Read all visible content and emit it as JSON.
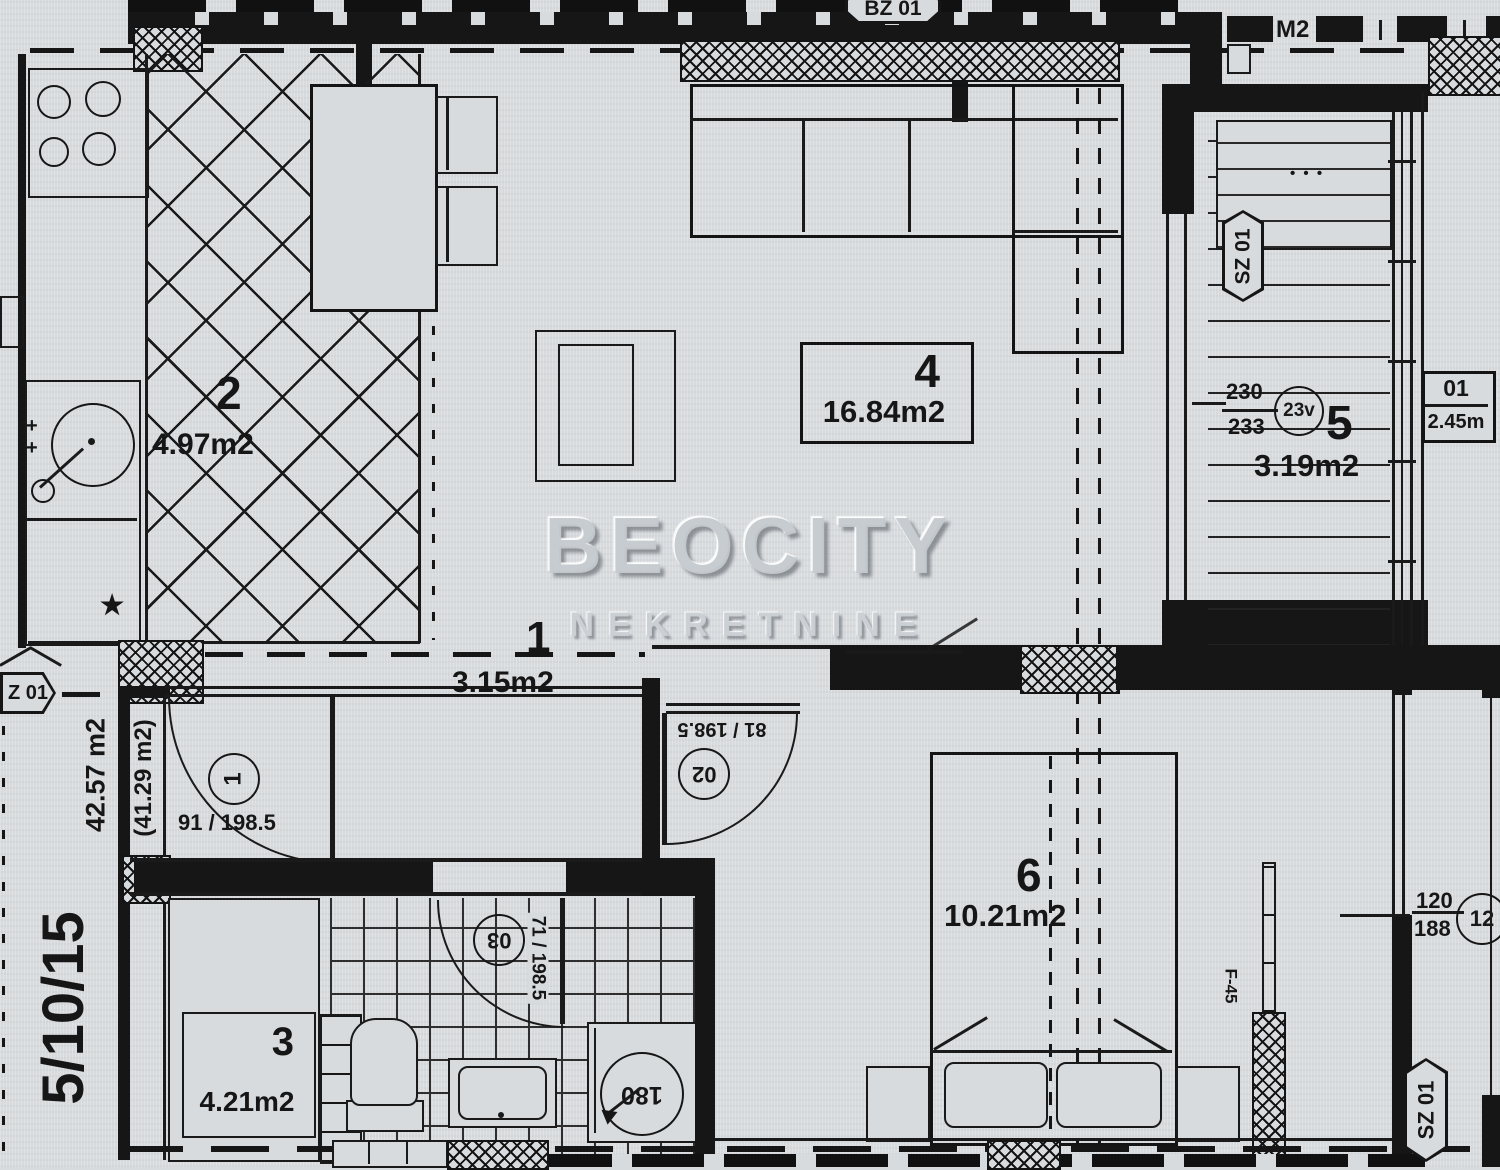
{
  "brand": {
    "watermark_line1": "BEOCITY",
    "watermark_line2": "NEKRETNINE"
  },
  "unit": {
    "total_area": "42.57 m2",
    "reduced_area": "(41.29 m2)",
    "unit_id": "5/10/15"
  },
  "rooms": {
    "hallway": {
      "number": "1",
      "area": "3.15m2"
    },
    "kitchen": {
      "number": "2",
      "area": "4.97m2"
    },
    "bathroom": {
      "number": "3",
      "area": "4.21m2"
    },
    "living": {
      "number": "4",
      "area": "16.84m2"
    },
    "terrace": {
      "number": "5",
      "area": "3.19m2"
    },
    "bedroom": {
      "number": "6",
      "area": "10.21m2"
    }
  },
  "doors": {
    "entry": {
      "circle": "1",
      "dim": "91 / 198.5"
    },
    "bedroom": {
      "circle": "02",
      "dim": "81 / 198.5"
    },
    "bathroom": {
      "circle": "03",
      "dim": "71 / 198.5"
    }
  },
  "openings": {
    "top_section": "BZ 01",
    "top_right": "M2",
    "terrace_door": "SZ 01",
    "bedroom_window_tag": "SZ 01",
    "entry_tag": "Z 01",
    "terrace_window": {
      "w": "230",
      "h": "233",
      "circle": "23v"
    },
    "terrace_box": {
      "id": "01",
      "width": "2.45m"
    },
    "bedroom_window": {
      "w": "120",
      "h": "188",
      "circle": "12"
    }
  },
  "fixtures": {
    "shower": "180",
    "radiator": "F-45",
    "planter_dots": "• • •",
    "star": "★",
    "plus": "+"
  }
}
